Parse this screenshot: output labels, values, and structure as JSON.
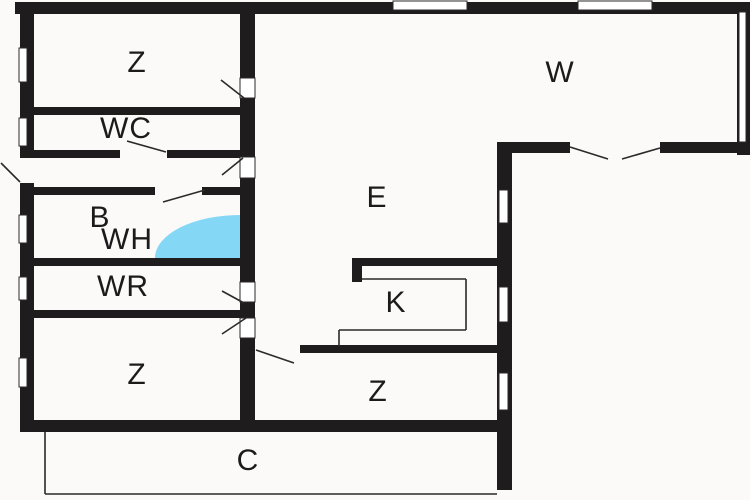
{
  "plan": {
    "canvas": {
      "w": 750,
      "h": 500
    },
    "colors": {
      "background": "#fbfaf9",
      "wall": "#1e1c1c",
      "line": "#2b2929",
      "window_fill": "#ffffff",
      "tub": "#84d7f5",
      "text": "#1c1a1a"
    },
    "walls": [
      {
        "x": 15,
        "y": 2,
        "w": 735,
        "h": 12
      },
      {
        "x": 20,
        "y": 2,
        "w": 14,
        "h": 156
      },
      {
        "x": 20,
        "y": 183,
        "w": 14,
        "h": 239
      },
      {
        "x": 20,
        "y": 420,
        "w": 492,
        "h": 12
      },
      {
        "x": 737,
        "y": 2,
        "w": 13,
        "h": 153
      },
      {
        "x": 497,
        "y": 142,
        "w": 15,
        "h": 348
      },
      {
        "x": 497,
        "y": 142,
        "w": 73,
        "h": 11
      },
      {
        "x": 660,
        "y": 142,
        "w": 90,
        "h": 11
      },
      {
        "x": 240,
        "y": 2,
        "w": 15,
        "h": 76
      },
      {
        "x": 240,
        "y": 98,
        "w": 15,
        "h": 59
      },
      {
        "x": 240,
        "y": 178,
        "w": 15,
        "h": 104
      },
      {
        "x": 240,
        "y": 302,
        "w": 15,
        "h": 16
      },
      {
        "x": 240,
        "y": 338,
        "w": 15,
        "h": 92
      },
      {
        "x": 28,
        "y": 107,
        "w": 212,
        "h": 8
      },
      {
        "x": 28,
        "y": 150,
        "w": 92,
        "h": 8
      },
      {
        "x": 167,
        "y": 150,
        "w": 73,
        "h": 8
      },
      {
        "x": 28,
        "y": 187,
        "w": 127,
        "h": 8
      },
      {
        "x": 202,
        "y": 187,
        "w": 38,
        "h": 8
      },
      {
        "x": 28,
        "y": 258,
        "w": 212,
        "h": 8
      },
      {
        "x": 28,
        "y": 310,
        "w": 227,
        "h": 8
      },
      {
        "x": 300,
        "y": 345,
        "w": 212,
        "h": 8
      },
      {
        "x": 352,
        "y": 258,
        "w": 148,
        "h": 8
      },
      {
        "x": 352,
        "y": 258,
        "w": 10,
        "h": 24
      }
    ],
    "windows": [
      {
        "x": 393,
        "y": 1,
        "w": 74,
        "h": 9
      },
      {
        "x": 578,
        "y": 1,
        "w": 74,
        "h": 9
      },
      {
        "x": 19,
        "y": 48,
        "w": 8,
        "h": 34
      },
      {
        "x": 19,
        "y": 118,
        "w": 8,
        "h": 28
      },
      {
        "x": 19,
        "y": 215,
        "w": 8,
        "h": 28
      },
      {
        "x": 19,
        "y": 277,
        "w": 8,
        "h": 23
      },
      {
        "x": 19,
        "y": 358,
        "w": 8,
        "h": 29
      },
      {
        "x": 499,
        "y": 190,
        "w": 9,
        "h": 33
      },
      {
        "x": 499,
        "y": 287,
        "w": 9,
        "h": 35
      },
      {
        "x": 499,
        "y": 373,
        "w": 9,
        "h": 37
      },
      {
        "x": 739,
        "y": 12,
        "w": 7,
        "h": 130
      }
    ],
    "door_openings": [
      {
        "x": 240,
        "y": 78,
        "w": 15,
        "h": 20
      },
      {
        "x": 240,
        "y": 157,
        "w": 15,
        "h": 21
      },
      {
        "x": 240,
        "y": 282,
        "w": 15,
        "h": 20
      },
      {
        "x": 240,
        "y": 318,
        "w": 15,
        "h": 20
      }
    ],
    "door_swings": [
      {
        "x1": 221,
        "y1": 80,
        "x2": 244,
        "y2": 98
      },
      {
        "x1": 222,
        "y1": 175,
        "x2": 243,
        "y2": 158
      },
      {
        "x1": 127,
        "y1": 141,
        "x2": 166,
        "y2": 152
      },
      {
        "x1": 163,
        "y1": 202,
        "x2": 205,
        "y2": 190
      },
      {
        "x1": 222,
        "y1": 291,
        "x2": 244,
        "y2": 303
      },
      {
        "x1": 222,
        "y1": 334,
        "x2": 246,
        "y2": 318
      },
      {
        "x1": 256,
        "y1": 350,
        "x2": 294,
        "y2": 363
      },
      {
        "x1": 570,
        "y1": 147,
        "x2": 608,
        "y2": 159
      },
      {
        "x1": 660,
        "y1": 148,
        "x2": 622,
        "y2": 159
      },
      {
        "x1": 1,
        "y1": 163,
        "x2": 20,
        "y2": 182
      }
    ],
    "thin_lines": [
      {
        "x1": 362,
        "y1": 279,
        "x2": 466,
        "y2": 279
      },
      {
        "x1": 466,
        "y1": 279,
        "x2": 466,
        "y2": 330
      },
      {
        "x1": 466,
        "y1": 330,
        "x2": 339,
        "y2": 330
      },
      {
        "x1": 339,
        "y1": 330,
        "x2": 339,
        "y2": 347
      },
      {
        "x1": 45,
        "y1": 432,
        "x2": 45,
        "y2": 494
      },
      {
        "x1": 45,
        "y1": 494,
        "x2": 497,
        "y2": 494
      }
    ],
    "tub": {
      "path": "M155,258 A85,43 0 0 1 240,215 L240,258 Z"
    },
    "labels": [
      {
        "text": "Z",
        "x": 137,
        "y": 63
      },
      {
        "text": "WC",
        "x": 126,
        "y": 129
      },
      {
        "text": "B",
        "x": 100,
        "y": 218
      },
      {
        "text": "WH",
        "x": 127,
        "y": 240
      },
      {
        "text": "WR",
        "x": 123,
        "y": 287
      },
      {
        "text": "Z",
        "x": 137,
        "y": 375
      },
      {
        "text": "E",
        "x": 377,
        "y": 198
      },
      {
        "text": "K",
        "x": 396,
        "y": 303
      },
      {
        "text": "Z",
        "x": 378,
        "y": 392
      },
      {
        "text": "W",
        "x": 560,
        "y": 73
      },
      {
        "text": "C",
        "x": 248,
        "y": 461
      }
    ]
  }
}
